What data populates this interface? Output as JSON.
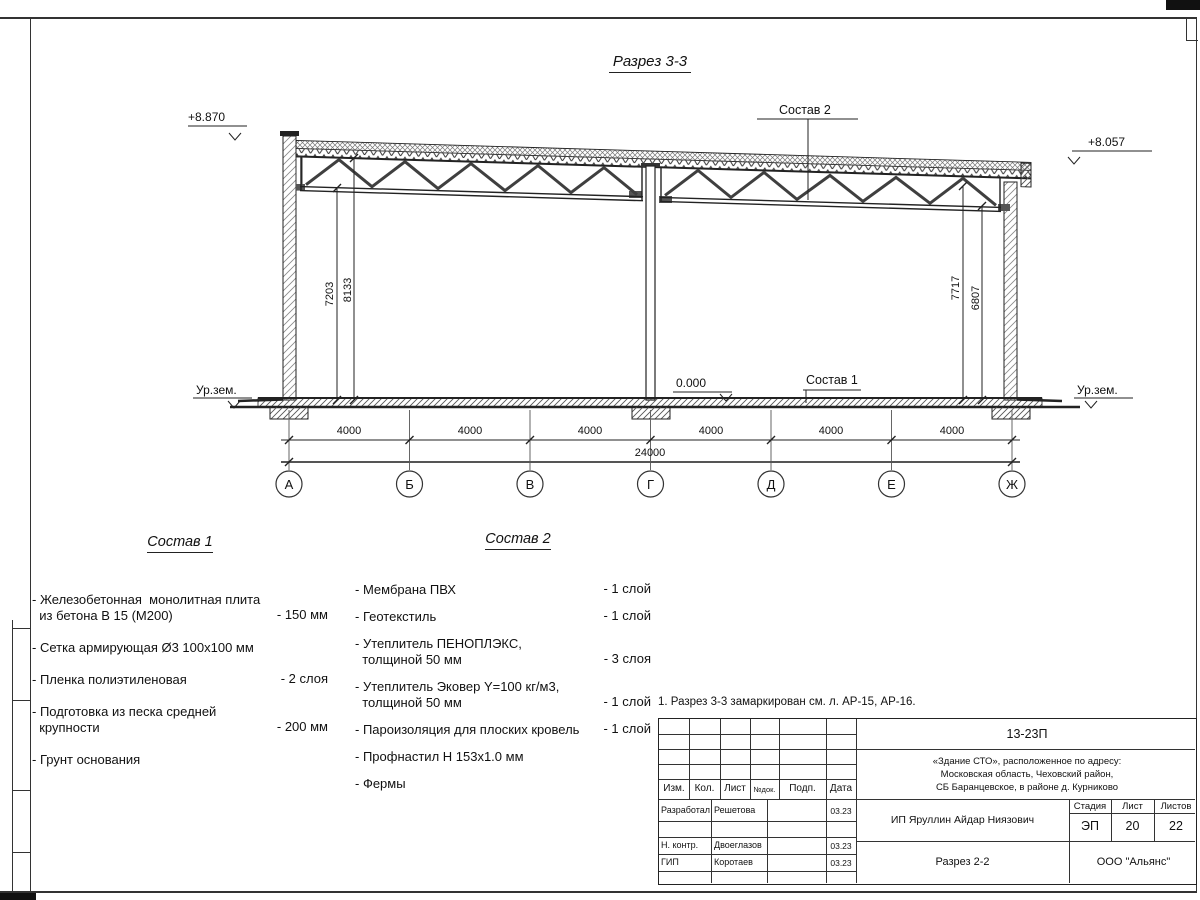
{
  "drawing": {
    "title": "Разрез 3-3",
    "elev_left": "+8.870",
    "elev_right": "+8.057",
    "elev_zero": "0.000",
    "ground_left": "Ур.зем.",
    "ground_right": "Ур.зем.",
    "leader_sostav1": "Состав 1",
    "leader_sostav2": "Состав 2",
    "dim_v": [
      "7203",
      "8133",
      "7717",
      "6807"
    ],
    "dim_bays": [
      "4000",
      "4000",
      "4000",
      "4000",
      "4000",
      "4000"
    ],
    "dim_total": "24000",
    "axes": [
      "А",
      "Б",
      "В",
      "Г",
      "Д",
      "Е",
      "Ж"
    ]
  },
  "sostav1": {
    "heading": "Состав 1",
    "items": [
      {
        "text": "- Железобетонная  монолитная плита\n  из бетона В 15 (М200)",
        "value": "- 150 мм"
      },
      {
        "text": "- Сетка армирующая Ø3 100х100 мм",
        "value": ""
      },
      {
        "text": "- Пленка полиэтиленовая",
        "value": "-  2 слоя"
      },
      {
        "text": "- Подготовка из песка средней\n  крупности",
        "value": "- 200 мм"
      },
      {
        "text": "- Грунт основания",
        "value": ""
      }
    ]
  },
  "sostav2": {
    "heading": "Состав 2",
    "items": [
      {
        "text": "- Мембрана ПВХ",
        "value": "- 1 слой"
      },
      {
        "text": "- Геотекстиль",
        "value": "- 1 слой"
      },
      {
        "text": "- Утеплитель ПЕНОПЛЭКС,\n  толщиной 50 мм",
        "value": "- 3 слоя"
      },
      {
        "text": "- Утеплитель Эковер Y=100 кг/м3,\n  толщиной 50 мм",
        "value": "- 1 слой"
      },
      {
        "text": "- Пароизоляция для плоских кровель",
        "value": "- 1 слой"
      },
      {
        "text": "- Профнастил Н 153х1.0 мм",
        "value": ""
      },
      {
        "text": "- Фермы",
        "value": ""
      }
    ]
  },
  "note": "1. Разрез 3-3 замаркирован см. л. АР-15, АР-16.",
  "titleblock": {
    "doc_number": "13-23П",
    "address_lines": [
      "«Здание СТО», расположенное по адресу:",
      "Московская область, Чеховский район,",
      "СБ Баранцевское, в районе д. Курниково"
    ],
    "cols": {
      "izm": "Изм.",
      "kol": "Кол.",
      "list": "Лист",
      "ndok": "№док.",
      "podp": "Подп.",
      "data": "Дата"
    },
    "rows": [
      {
        "role": "Разработал",
        "name": "Решетова",
        "date": "03.23"
      },
      {
        "role": "Н. контр.",
        "name": "Двоеглазов",
        "date": "03.23"
      },
      {
        "role": "ГИП",
        "name": "Коротаев",
        "date": "03.23"
      }
    ],
    "client": "ИП Яруллин Айдар Ниязович",
    "stage_label": "Стадия",
    "sheet_label": "Лист",
    "sheets_label": "Листов",
    "stage": "ЭП",
    "sheet_no": "20",
    "sheets_total": "22",
    "section_name": "Разрез 2-2",
    "company": "ООО \"Альянс\""
  }
}
